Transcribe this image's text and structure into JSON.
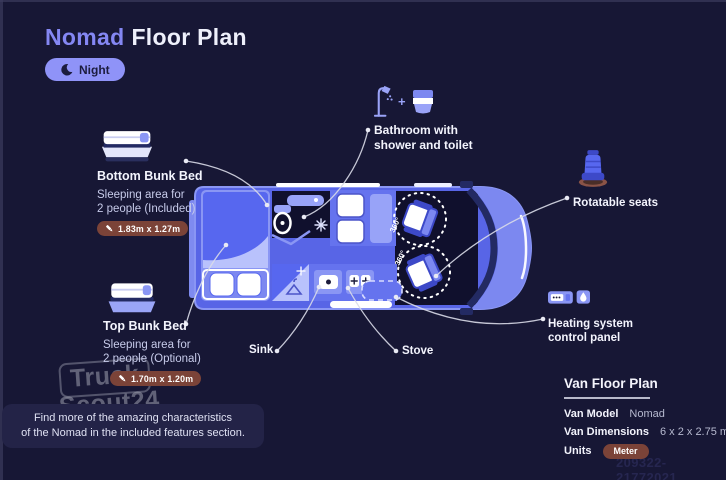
{
  "colors": {
    "background": "#171735",
    "accent_periwinkle": "#8f93f8",
    "title_accent": "#8487f3",
    "van_blue": "#5865e6",
    "van_light_blue": "#8a96f4",
    "badge_maroon": "#7b4338",
    "text_primary": "#f3f4fd",
    "text_muted": "#c7cbea"
  },
  "header": {
    "title_accent": "Nomad",
    "title_rest": "Floor Plan",
    "mode_label": "Night"
  },
  "annotations": {
    "bottom_bunk": {
      "title": "Bottom Bunk Bed",
      "desc1": "Sleeping area for",
      "desc2": "2 people (Included)",
      "dimensions": "1.83m x 1.27m"
    },
    "top_bunk": {
      "title": "Top Bunk Bed",
      "desc1": "Sleeping area for",
      "desc2": "2 people (Optional)",
      "dimensions": "1.70m x 1.20m"
    },
    "bathroom": {
      "line1": "Bathroom with",
      "line2": "shower and toilet",
      "plus": "+"
    },
    "rotatable_seats": {
      "label": "Rotatable seats"
    },
    "heating": {
      "line1": "Heating system",
      "line2": "control panel"
    },
    "sink": {
      "label": "Sink"
    },
    "stove": {
      "label": "Stove"
    }
  },
  "floorplan": {
    "rotation_label": "360°"
  },
  "footnote": {
    "line1": "Find more of the amazing characteristics",
    "line2": "of the Nomad in the included features section."
  },
  "info_panel": {
    "title": "Van Floor Plan",
    "model_label": "Van Model",
    "model_value": "Nomad",
    "dimensions_label": "Van Dimensions",
    "dimensions_value": "6 x 2 x 2.75 m",
    "units_label": "Units",
    "units_value": "Meter"
  },
  "watermarks": {
    "brand_top": "Truck",
    "brand_bottom": "Scout24",
    "id_number": "209322-21772021"
  }
}
